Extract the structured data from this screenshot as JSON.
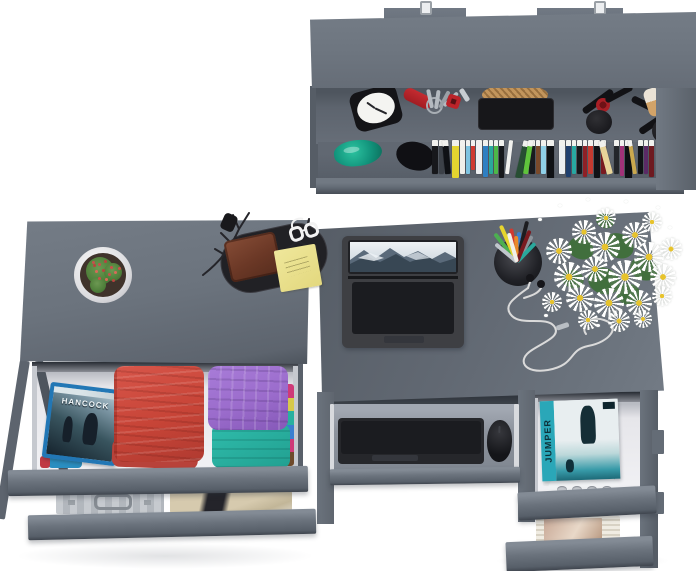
{
  "scene": {
    "type": "3d-furniture-render",
    "description": "Top view of a gray home-office furniture set on a white background: wall shelf with accessories and books, dresser with open clothing drawers, desk with laptop and pull-out keyboard tray, and media drawers",
    "palette": {
      "bg": "#ffffff",
      "gray-top": "#6e7680",
      "gray-top-dark": "#5f666f",
      "gray-front": "#68707a",
      "gray-side": "#59606a",
      "gray-shadow": "#454b54",
      "interior": "#e9e9ec",
      "recess": "#31363e"
    }
  },
  "wall_shelf": {
    "objects": [
      "alarm clock",
      "pocket knife",
      "key ring with keys",
      "woven basket on black tray",
      "lipstick and mascara",
      "makeup brush",
      "powder pads",
      "green glass vase",
      "black vase",
      "row of books"
    ],
    "books": [
      {
        "c": "#17181c",
        "w": 6
      },
      {
        "c": "#3c4148",
        "w": 5
      },
      {
        "c": "#0f1115",
        "w": 6,
        "t": -5
      },
      {
        "c": "#e4d430",
        "w": 7,
        "h": 38
      },
      {
        "c": "#f0efe9",
        "w": 5
      },
      {
        "c": "#7ec3e0",
        "w": 4
      },
      {
        "c": "#cf3a31",
        "w": 4,
        "h": 30
      },
      {
        "c": "#eef0f2",
        "w": 6
      },
      {
        "c": "#2f7fc2",
        "w": 5,
        "h": 37
      },
      {
        "c": "#2aa89c",
        "w": 4
      },
      {
        "c": "#4db848",
        "w": 4
      },
      {
        "c": "#15171b",
        "w": 5,
        "h": 38
      },
      {
        "c": "#f0f0ee",
        "w": 4,
        "t": 7
      },
      {
        "gap": 5
      },
      {
        "c": "#274e33",
        "w": 7,
        "t": 13,
        "h": 38
      },
      {
        "c": "#5fc33c",
        "w": 5,
        "t": 9
      },
      {
        "c": "#191b1f",
        "w": 6
      },
      {
        "c": "#7a4a2b",
        "w": 4
      },
      {
        "c": "#8fd0e8",
        "w": 5
      },
      {
        "c": "#0f1114",
        "w": 7,
        "h": 39
      },
      {
        "gap": 4
      },
      {
        "c": "#eceff1",
        "w": 6
      },
      {
        "c": "#20406e",
        "w": 5,
        "h": 37
      },
      {
        "c": "#28a8a2",
        "w": 4
      },
      {
        "c": "#16181c",
        "w": 5
      },
      {
        "c": "#8e2026",
        "w": 4,
        "h": 37
      },
      {
        "c": "#c33a30",
        "w": 5
      },
      {
        "c": "#101216",
        "w": 6,
        "h": 38
      },
      {
        "c": "#7a1a20",
        "w": 5
      },
      {
        "c": "#e8d49a",
        "w": 6,
        "t": -15
      },
      {
        "c": "#23262b",
        "w": 5
      },
      {
        "c": "#a23278",
        "w": 4,
        "h": 36
      },
      {
        "c": "#0e0f13",
        "w": 7,
        "h": 39
      },
      {
        "c": "#caa84e",
        "w": 4,
        "t": -9
      },
      {
        "c": "#101216",
        "w": 5
      },
      {
        "c": "#5b2a66",
        "w": 4
      },
      {
        "c": "#6e1a20",
        "w": 5,
        "h": 37
      }
    ]
  },
  "dresser": {
    "objects": [
      "cactus in white pot",
      "black valet tray",
      "leather wallet",
      "yellow sticky notes",
      "reading glasses",
      "decorative black branches",
      "folded red towels",
      "folded shirt stack",
      "aluminum briefcase",
      "khaki trousers with black belt"
    ],
    "bluray": {
      "title": "HANCOCK",
      "frame_color": "#2277b5"
    },
    "clothes_colors": {
      "red": "#cd4a3f",
      "red_dark": "#b8423a",
      "purple": "#9b6ccc",
      "teal": "#28b0a0",
      "pink": "#cf3a78",
      "yellow": "#d6c84a",
      "blue": "#3a7fd0"
    },
    "briefcase_color": "#b9bdc2",
    "pants_color": "#c9bda1"
  },
  "desk": {
    "objects": [
      "open laptop with mountain wallpaper",
      "black pen cup",
      "white daisy bouquet",
      "white earphones",
      "wireless keyboard on pull-out tray",
      "wireless mouse",
      "dvd stack",
      "white charging dock",
      "magazine stack"
    ],
    "dvd": {
      "title": "JUMPER",
      "accent_color": "#2aa7b8"
    },
    "pen_cup": {
      "pens": [
        {
          "c": "#4caf50",
          "r": -38,
          "l": 36
        },
        {
          "c": "#e6d52e",
          "r": -24,
          "l": 40
        },
        {
          "c": "#c0c6cc",
          "r": -50,
          "l": 28
        },
        {
          "c": "#cf3a31",
          "r": -10,
          "l": 34
        },
        {
          "c": "#3a7fd0",
          "r": 4,
          "l": 30
        },
        {
          "c": "#1d1d21",
          "r": 14,
          "l": 42
        },
        {
          "c": "#8d939a",
          "r": 30,
          "l": 30
        },
        {
          "c": "#e8892a",
          "r": -2,
          "l": 26
        },
        {
          "c": "#2aa89c",
          "r": 44,
          "l": 26
        },
        {
          "c": "#7a1a20",
          "r": 22,
          "l": 34
        },
        {
          "c": "#f0efe9",
          "r": -16,
          "l": 30
        }
      ]
    },
    "flowers": {
      "petal": "#ffffff",
      "center": "#e7c32c",
      "leaf": "#3f6f3a",
      "blooms": [
        [
          8,
          40,
          26
        ],
        [
          34,
          22,
          24
        ],
        [
          58,
          10,
          20
        ],
        [
          52,
          34,
          30
        ],
        [
          84,
          24,
          26
        ],
        [
          104,
          14,
          20
        ],
        [
          96,
          44,
          30
        ],
        [
          122,
          40,
          22
        ],
        [
          16,
          64,
          30
        ],
        [
          44,
          58,
          26
        ],
        [
          70,
          62,
          34
        ],
        [
          112,
          66,
          26
        ],
        [
          28,
          86,
          28
        ],
        [
          56,
          90,
          30
        ],
        [
          88,
          92,
          26
        ],
        [
          114,
          88,
          20
        ],
        [
          4,
          94,
          20
        ],
        [
          70,
          112,
          22
        ],
        [
          40,
          112,
          20
        ],
        [
          96,
          112,
          18
        ]
      ],
      "leaves": [
        [
          30,
          40,
          26
        ],
        [
          66,
          36,
          30
        ],
        [
          50,
          70,
          32
        ],
        [
          92,
          60,
          28
        ],
        [
          24,
          72,
          22
        ],
        [
          78,
          86,
          26
        ],
        [
          58,
          16,
          18
        ]
      ],
      "specks": [
        [
          0,
          20
        ],
        [
          20,
          6
        ],
        [
          48,
          0
        ],
        [
          86,
          2
        ],
        [
          118,
          8
        ],
        [
          130,
          28
        ],
        [
          128,
          58
        ],
        [
          6,
          116
        ],
        [
          58,
          126
        ],
        [
          100,
          122
        ]
      ]
    }
  }
}
